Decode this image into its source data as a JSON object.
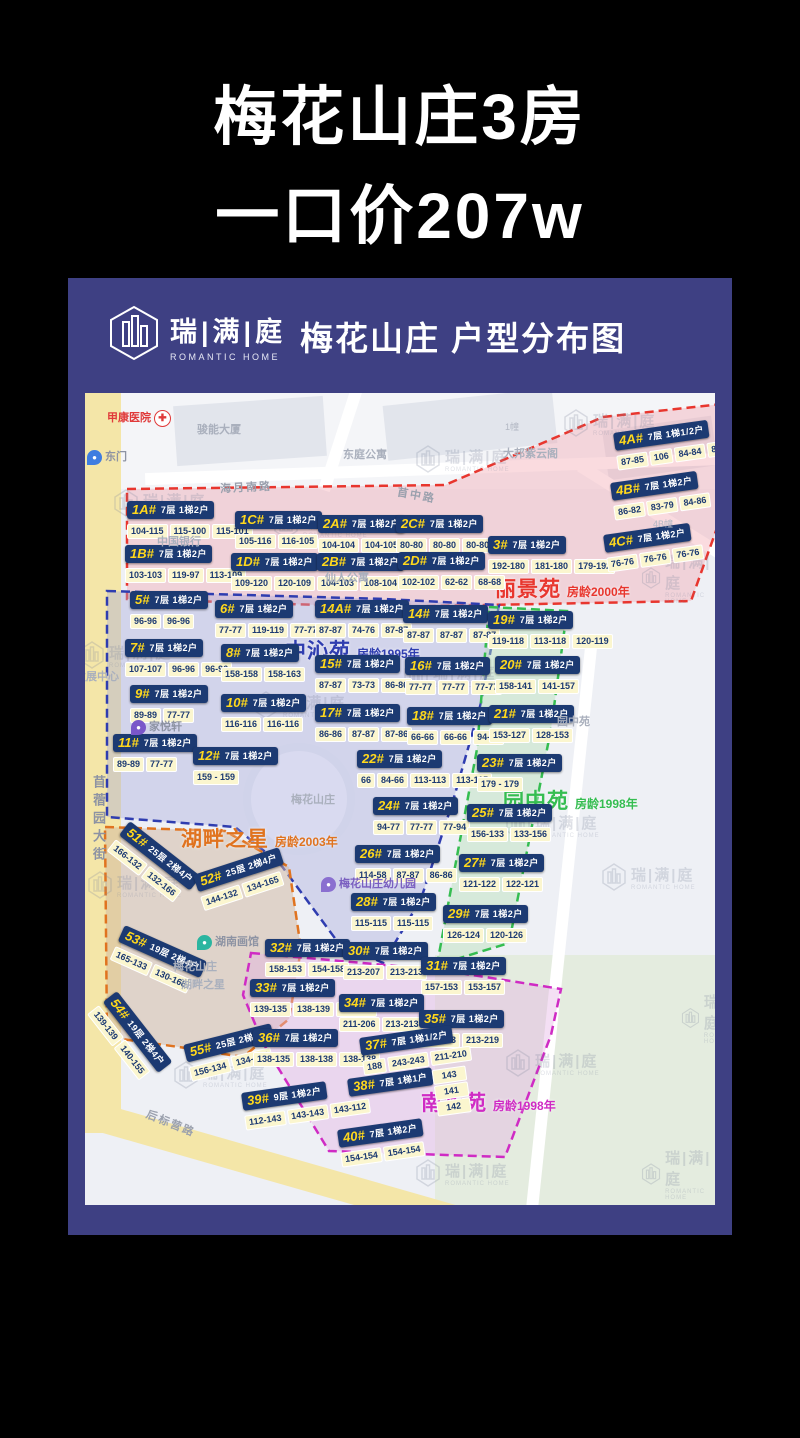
{
  "page": {
    "title_line1": "梅花山庄3房",
    "title_line2": "一口价207w"
  },
  "card": {
    "brand_cn": "瑞|满|庭",
    "brand_en": "ROMANTIC HOME",
    "title": "梅花山庄 户型分布图"
  },
  "map": {
    "regions": [
      {
        "id": "lijingyuan",
        "name": "丽景苑",
        "age": "房龄2000年",
        "color": "#e8362e",
        "fill": "rgba(242,166,176,0.40)",
        "polygon": "42,96 360,92 518,24 646,10 638,118 606,208 300,214 42,206",
        "label_x": 410,
        "label_y": 180
      },
      {
        "id": "zhongqinyuan",
        "name": "中沁苑",
        "age": "房龄1995年",
        "color": "#2f3db0",
        "fill": "rgba(168,170,220,0.40)",
        "polygon": "22,198 300,206 414,212 396,310 368,408 336,506 298,570 252,548 196,472 150,434 22,424",
        "label_x": 200,
        "label_y": 242
      },
      {
        "id": "yuanzhongyuan",
        "name": "园中苑",
        "age": "房龄1998年",
        "color": "#35bd51",
        "fill": "rgba(184,224,186,0.45)",
        "polygon": "404,214 482,218 466,336 444,448 424,550 352,572 370,474 392,356",
        "label_x": 418,
        "label_y": 392
      },
      {
        "id": "hupanzhixing",
        "name": "湖畔之星",
        "age": "房龄2003年",
        "color": "#e0731f",
        "fill": "rgba(208,182,160,0.50)",
        "polygon": "20,434 140,438 204,474 216,556 204,626 158,664 94,654 22,644",
        "label_x": 96,
        "label_y": 430
      },
      {
        "id": "nanhuayuan",
        "name": "南华苑",
        "age": "房龄1998年",
        "color": "#cf2bc4",
        "fill": "rgba(228,178,228,0.42)",
        "polygon": "166,560 300,572 362,578 476,596 466,642 420,764 244,758 178,650 158,602",
        "label_x": 336,
        "label_y": 694
      }
    ],
    "buildings": [
      {
        "id": "1A#",
        "floors": "7层",
        "units": "1梯2户",
        "cells": [
          "104-115",
          "115-100",
          "115-101"
        ],
        "x": 42,
        "y": 108
      },
      {
        "id": "1B#",
        "floors": "7层",
        "units": "1梯2户",
        "cells": [
          "103-103",
          "119-97",
          "113-109"
        ],
        "x": 40,
        "y": 152
      },
      {
        "id": "1C#",
        "floors": "7层",
        "units": "1梯2户",
        "cells": [
          "105-116",
          "116-105"
        ],
        "x": 150,
        "y": 118
      },
      {
        "id": "1D#",
        "floors": "7层",
        "units": "1梯2户",
        "cells": [
          "109-120",
          "120-109"
        ],
        "x": 146,
        "y": 160
      },
      {
        "id": "2A#",
        "floors": "7层",
        "units": "1梯2户",
        "cells": [
          "104-104",
          "104-105"
        ],
        "x": 233,
        "y": 122
      },
      {
        "id": "2B#",
        "floors": "7层",
        "units": "1梯2户",
        "cells": [
          "104-103",
          "108-104"
        ],
        "x": 232,
        "y": 160
      },
      {
        "id": "2C#",
        "floors": "7层",
        "units": "1梯2户",
        "cells": [
          "80-80",
          "80-80",
          "80-80"
        ],
        "x": 311,
        "y": 122
      },
      {
        "id": "2D#",
        "floors": "7层",
        "units": "1梯2户",
        "cells": [
          "102-102",
          "62-62",
          "68-68"
        ],
        "x": 313,
        "y": 159
      },
      {
        "id": "3#",
        "floors": "7层",
        "units": "1梯2户",
        "cells": [
          "192-180",
          "181-180",
          "179-192"
        ],
        "x": 403,
        "y": 143
      },
      {
        "id": "4A#",
        "floors": "7层",
        "units": "1梯1/2户",
        "cells": [
          "87-85",
          "106",
          "84-84",
          "87-87"
        ],
        "x": 528,
        "y": 40,
        "rot": -8
      },
      {
        "id": "4B#",
        "floors": "7层",
        "units": "1梯2户",
        "cells": [
          "86-82",
          "83-79",
          "84-86"
        ],
        "x": 525,
        "y": 90,
        "rot": -8
      },
      {
        "id": "4C#",
        "floors": "7层",
        "units": "1梯2户",
        "cells": [
          "76-76",
          "76-76",
          "76-76"
        ],
        "x": 518,
        "y": 142,
        "rot": -8
      },
      {
        "id": "5#",
        "floors": "7层",
        "units": "1梯2户",
        "cells": [
          "96-96",
          "96-96"
        ],
        "x": 45,
        "y": 198
      },
      {
        "id": "6#",
        "floors": "7层",
        "units": "1梯2户",
        "cells": [
          "77-77",
          "119-119",
          "77-77"
        ],
        "x": 130,
        "y": 207
      },
      {
        "id": "7#",
        "floors": "7层",
        "units": "1梯2户",
        "cells": [
          "107-107",
          "96-96",
          "96-96"
        ],
        "x": 40,
        "y": 246
      },
      {
        "id": "8#",
        "floors": "7层",
        "units": "1梯2户",
        "cells": [
          "158-158",
          "158-163"
        ],
        "x": 136,
        "y": 251
      },
      {
        "id": "9#",
        "floors": "7层",
        "units": "1梯2户",
        "cells": [
          "89-89",
          "77-77"
        ],
        "x": 45,
        "y": 292
      },
      {
        "id": "10#",
        "floors": "7层",
        "units": "1梯2户",
        "cells": [
          "116-116",
          "116-116"
        ],
        "x": 136,
        "y": 301
      },
      {
        "id": "11#",
        "floors": "7层",
        "units": "1梯2户",
        "cells": [
          "89-89",
          "77-77"
        ],
        "x": 28,
        "y": 341
      },
      {
        "id": "12#",
        "floors": "7层",
        "units": "1梯2户",
        "cells": [
          "159 - 159"
        ],
        "x": 108,
        "y": 354
      },
      {
        "id": "14A#",
        "floors": "7层",
        "units": "1梯2户",
        "cells": [
          "87-87",
          "74-76",
          "87-87"
        ],
        "x": 230,
        "y": 207
      },
      {
        "id": "14#",
        "floors": "7层",
        "units": "1梯2户",
        "cells": [
          "87-87",
          "87-87",
          "87-87"
        ],
        "x": 318,
        "y": 212
      },
      {
        "id": "15#",
        "floors": "7层",
        "units": "1梯2户",
        "cells": [
          "87-87",
          "73-73",
          "86-86"
        ],
        "x": 230,
        "y": 262
      },
      {
        "id": "16#",
        "floors": "7层",
        "units": "1梯2户",
        "cells": [
          "77-77",
          "77-77",
          "77-77"
        ],
        "x": 320,
        "y": 264
      },
      {
        "id": "17#",
        "floors": "7层",
        "units": "1梯2户",
        "cells": [
          "86-86",
          "87-87",
          "87-86"
        ],
        "x": 230,
        "y": 311
      },
      {
        "id": "18#",
        "floors": "7层",
        "units": "1梯2户",
        "cells": [
          "66-66",
          "66-66",
          "94-94"
        ],
        "x": 322,
        "y": 314
      },
      {
        "id": "22#",
        "floors": "7层",
        "units": "1梯2户",
        "cells": [
          "66",
          "84-66",
          "113-113",
          "113-115"
        ],
        "x": 272,
        "y": 357
      },
      {
        "id": "24#",
        "floors": "7层",
        "units": "1梯2户",
        "cells": [
          "94-77",
          "77-77",
          "77-94"
        ],
        "x": 288,
        "y": 404
      },
      {
        "id": "26#",
        "floors": "7层",
        "units": "1梯2户",
        "cells": [
          "114-58",
          "87-87",
          "86-86"
        ],
        "x": 270,
        "y": 452
      },
      {
        "id": "28#",
        "floors": "7层",
        "units": "1梯2户",
        "cells": [
          "115-115",
          "115-115"
        ],
        "x": 266,
        "y": 500
      },
      {
        "id": "19#",
        "floors": "7层",
        "units": "1梯2户",
        "cells": [
          "119-118",
          "113-118",
          "120-119"
        ],
        "x": 403,
        "y": 218
      },
      {
        "id": "20#",
        "floors": "7层",
        "units": "1梯2户",
        "cells": [
          "158-141",
          "141-157"
        ],
        "x": 410,
        "y": 263
      },
      {
        "id": "21#",
        "floors": "7层",
        "units": "1梯2户",
        "cells": [
          "153-127",
          "128-153"
        ],
        "x": 404,
        "y": 312
      },
      {
        "id": "23#",
        "floors": "7层",
        "units": "1梯2户",
        "cells": [
          "179 - 179"
        ],
        "x": 392,
        "y": 361
      },
      {
        "id": "25#",
        "floors": "7层",
        "units": "1梯2户",
        "cells": [
          "156-133",
          "133-156"
        ],
        "x": 382,
        "y": 411
      },
      {
        "id": "27#",
        "floors": "7层",
        "units": "1梯2户",
        "cells": [
          "121-122",
          "122-121"
        ],
        "x": 374,
        "y": 461
      },
      {
        "id": "29#",
        "floors": "7层",
        "units": "1梯2户",
        "cells": [
          "126-124",
          "120-126"
        ],
        "x": 358,
        "y": 512
      },
      {
        "id": "51#",
        "floors": "25层",
        "units": "2梯4户",
        "cells": [
          "166-132",
          "132-166"
        ],
        "x": 45,
        "y": 428,
        "rot": 38
      },
      {
        "id": "52#",
        "floors": "25层",
        "units": "2梯4户",
        "cells": [
          "144-132",
          "134-165"
        ],
        "x": 108,
        "y": 482,
        "rot": -18
      },
      {
        "id": "53#",
        "floors": "19层",
        "units": "2梯4户",
        "cells": [
          "165-133",
          "130-166"
        ],
        "x": 40,
        "y": 532,
        "rot": 24
      },
      {
        "id": "54#",
        "floors": "19层",
        "units": "2梯4户",
        "cells": [
          "139-139",
          "140-155"
        ],
        "x": 32,
        "y": 598,
        "rot": 52
      },
      {
        "id": "55#",
        "floors": "25层",
        "units": "2梯4户",
        "cells": [
          "156-134",
          "134-165"
        ],
        "x": 98,
        "y": 652,
        "rot": -14
      },
      {
        "id": "32#",
        "floors": "7层",
        "units": "1梯2户",
        "cells": [
          "158-153",
          "154-158"
        ],
        "x": 180,
        "y": 546
      },
      {
        "id": "30#",
        "floors": "7层",
        "units": "1梯2户",
        "cells": [
          "213-207",
          "213-213"
        ],
        "x": 258,
        "y": 549
      },
      {
        "id": "31#",
        "floors": "7层",
        "units": "1梯2户",
        "cells": [
          "157-153",
          "153-157"
        ],
        "x": 336,
        "y": 564
      },
      {
        "id": "33#",
        "floors": "7层",
        "units": "1梯2户",
        "cells": [
          "139-135",
          "138-139",
          "138-138"
        ],
        "x": 165,
        "y": 586
      },
      {
        "id": "34#",
        "floors": "7层",
        "units": "1梯2户",
        "cells": [
          "211-206",
          "213-213"
        ],
        "x": 254,
        "y": 601
      },
      {
        "id": "35#",
        "floors": "7层",
        "units": "1梯2户",
        "cells": [
          "213-213",
          "213-219"
        ],
        "x": 334,
        "y": 617
      },
      {
        "id": "36#",
        "floors": "7层",
        "units": "1梯2户",
        "cells": [
          "138-135",
          "138-138",
          "138-138"
        ],
        "x": 168,
        "y": 636
      },
      {
        "id": "37#",
        "floors": "7层",
        "units": "1梯1/2户",
        "cells": [
          "188",
          "243-243",
          "211-210"
        ],
        "x": 274,
        "y": 645,
        "rot": -8
      },
      {
        "id": "38#",
        "floors": "7层",
        "units": "1梯1户",
        "cells": [
          "143",
          "141",
          "142"
        ],
        "x": 262,
        "y": 686,
        "rot": -8,
        "stack": true
      },
      {
        "id": "39#",
        "floors": "9层",
        "units": "1梯2户",
        "cells": [
          "112-143",
          "143-143",
          "143-112"
        ],
        "x": 156,
        "y": 700,
        "rot": -8
      },
      {
        "id": "40#",
        "floors": "7层",
        "units": "1梯2户",
        "cells": [
          "154-154",
          "154-154"
        ],
        "x": 252,
        "y": 737,
        "rot": -8
      }
    ],
    "pois": [
      {
        "type": "hospital",
        "label": "甲康医院",
        "x": 22,
        "y": 16
      },
      {
        "type": "text",
        "label": "骏能大厦",
        "x": 112,
        "y": 28,
        "cls": "faint"
      },
      {
        "type": "text",
        "label": "东庭公寓",
        "x": 258,
        "y": 53,
        "cls": "faint"
      },
      {
        "type": "text",
        "label": "大邦紫云阁",
        "x": 418,
        "y": 52,
        "cls": "faint"
      },
      {
        "type": "text",
        "label": "1幢",
        "x": 420,
        "y": 27,
        "cls": "tiny"
      },
      {
        "type": "text",
        "label": "4B幢",
        "x": 568,
        "y": 124,
        "cls": "tiny"
      },
      {
        "type": "pin",
        "label": "东门",
        "x": 2,
        "y": 55,
        "pin": "#3f7de0"
      },
      {
        "type": "text",
        "label": "海月南路",
        "x": 135,
        "y": 86,
        "cls": "roadlab",
        "rot": -3
      },
      {
        "type": "text",
        "label": "苜中路",
        "x": 312,
        "y": 94,
        "cls": "roadlab",
        "rot": 10
      },
      {
        "type": "text",
        "label": "中国银行",
        "x": 72,
        "y": 140,
        "cls": "faint"
      },
      {
        "type": "text",
        "label": "仙人公寓",
        "x": 240,
        "y": 176,
        "cls": "faint"
      },
      {
        "type": "text",
        "label": "发展中心",
        "x": -10,
        "y": 275,
        "cls": "faint"
      },
      {
        "type": "pin",
        "label": "家悦轩",
        "x": 46,
        "y": 325,
        "pin": "#7a57c9"
      },
      {
        "type": "text",
        "label": "苜蓿园大街",
        "x": 4,
        "y": 382,
        "cls": "road-v"
      },
      {
        "type": "text",
        "label": "梅花山庄",
        "x": 206,
        "y": 398,
        "cls": "faint"
      },
      {
        "type": "text",
        "label": "园中苑",
        "x": 472,
        "y": 320,
        "cls": "faint"
      },
      {
        "type": "pin",
        "label": "湖南画馆",
        "x": 112,
        "y": 540,
        "pin": "#2bb5a0"
      },
      {
        "type": "text",
        "label": "梅花山庄",
        "x": 88,
        "y": 565,
        "cls": "faint"
      },
      {
        "type": "text",
        "label": "湖畔之星",
        "x": 96,
        "y": 583,
        "cls": "faint"
      },
      {
        "type": "kind",
        "label": "梅花山庄幼儿园",
        "x": 236,
        "y": 482
      },
      {
        "type": "text",
        "label": "后标营路",
        "x": 60,
        "y": 722,
        "cls": "roadlab",
        "rot": 22
      }
    ],
    "watermark": {
      "cn": "瑞|满|庭",
      "en": "ROMANTIC HOME",
      "positions": [
        {
          "x": 28,
          "y": 96
        },
        {
          "x": 330,
          "y": 52
        },
        {
          "x": 478,
          "y": 16
        },
        {
          "x": 556,
          "y": 158
        },
        {
          "x": -6,
          "y": 248
        },
        {
          "x": 318,
          "y": 268
        },
        {
          "x": 168,
          "y": 298
        },
        {
          "x": 420,
          "y": 418
        },
        {
          "x": 2,
          "y": 478
        },
        {
          "x": 516,
          "y": 470
        },
        {
          "x": 596,
          "y": 598
        },
        {
          "x": 420,
          "y": 656
        },
        {
          "x": 88,
          "y": 668
        },
        {
          "x": 330,
          "y": 766
        },
        {
          "x": 556,
          "y": 754
        },
        {
          "x": 188,
          "y": 118
        }
      ]
    }
  }
}
